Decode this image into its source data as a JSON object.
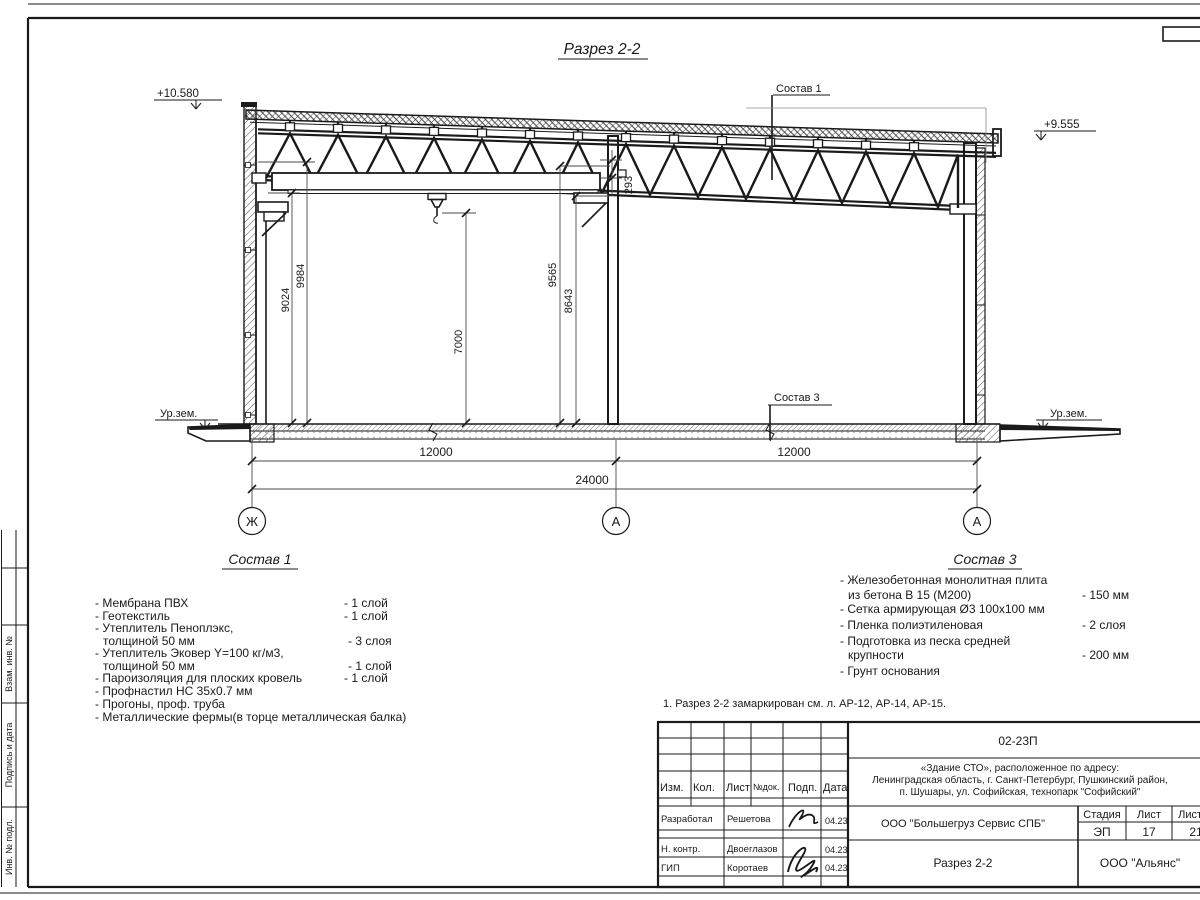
{
  "colors": {
    "ink": "#1a1a1a",
    "paper": "#ffffff"
  },
  "drawing": {
    "title": "Разрез 2-2",
    "level_left": "+10.580",
    "level_right": "+9.555",
    "ground_left": "Ур.зем.",
    "ground_right": "Ур.зем.",
    "callout_sostav1": "Состав 1",
    "callout_sostav3": "Состав 3",
    "dim_9024": "9024",
    "dim_9984": "9984",
    "dim_7000": "7000",
    "dim_9565": "9565",
    "dim_8643": "8643",
    "dim_293": "293",
    "dim_span_left": "12000",
    "dim_span_right": "12000",
    "dim_total": "24000",
    "axis_left": "Ж",
    "axis_mid": "А",
    "axis_right": "А"
  },
  "sostav1": {
    "heading": "Состав 1",
    "items": [
      {
        "text": "- Мембрана ПВХ",
        "value": "- 1 слой"
      },
      {
        "text": "- Геотекстиль",
        "value": "- 1 слой"
      },
      {
        "text": "- Утеплитель Пеноплэкс,",
        "value": ""
      },
      {
        "text": "толщиной 50 мм",
        "value": "- 3 слоя"
      },
      {
        "text": "- Утеплитель Эковер Y=100 кг/м3,",
        "value": ""
      },
      {
        "text": "толщиной 50 мм",
        "value": "- 1 слой"
      },
      {
        "text": "- Пароизоляция для плоских кровель",
        "value": "- 1 слой"
      },
      {
        "text": "- Профнастил НС 35х0.7 мм",
        "value": ""
      },
      {
        "text": "- Прогоны, проф. труба",
        "value": ""
      },
      {
        "text": "- Металлические фермы(в торце металлическая балка)",
        "value": ""
      }
    ]
  },
  "sostav3": {
    "heading": "Состав 3",
    "items": [
      {
        "text": "- Железобетонная  монолитная плита",
        "value": ""
      },
      {
        "text": "из бетона В 15 (М200)",
        "value": "- 150 мм"
      },
      {
        "text": "- Сетка армирующая Ø3 100х100 мм",
        "value": ""
      },
      {
        "text": "- Пленка полиэтиленовая",
        "value": "-  2 слоя"
      },
      {
        "text": "- Подготовка из песка средней",
        "value": ""
      },
      {
        "text": "крупности",
        "value": "- 200 мм"
      },
      {
        "text": "- Грунт основания",
        "value": ""
      }
    ]
  },
  "note": "1. Разрез 2-2 замаркирован см. л. АР-12, АР-14, АР-15.",
  "title_block": {
    "doc_number": "02-23П",
    "project_line1": "«Здание СТО», расположенное по адресу:",
    "project_line2": "Ленинградская область, г. Санкт-Петербург, Пушкинский район,",
    "project_line3": "п. Шушары, ул. Софийская, технопарк \"Софийский\"",
    "col_izm": "Изм.",
    "col_kol": "Кол.",
    "col_list": "Лист",
    "col_ndok": "№док.",
    "col_podp": "Подп.",
    "col_data": "Дата",
    "row1_role": "Разработал",
    "row1_name": "Решетова",
    "row1_date": "04.23",
    "row2_role": "Н. контр.",
    "row2_name": "Двоеглазов",
    "row2_date": "04.23",
    "row3_role": "ГИП",
    "row3_name": "Коротаев",
    "row3_date": "04.23",
    "contractor": "ООО \"Большегруз Сервис СПБ\"",
    "sheet_title": "Разрез 2-2",
    "org": "ООО \"Альянс\"",
    "stage_label": "Стадия",
    "sheet_label": "Лист",
    "sheets_label": "Листов",
    "stage": "ЭП",
    "sheet_num": "17",
    "sheets_total": "21"
  },
  "side_stamp": {
    "label_top": "Взам. инв. №",
    "label_mid": "Подпись и дата",
    "label_bottom": "Инв. № подл."
  }
}
